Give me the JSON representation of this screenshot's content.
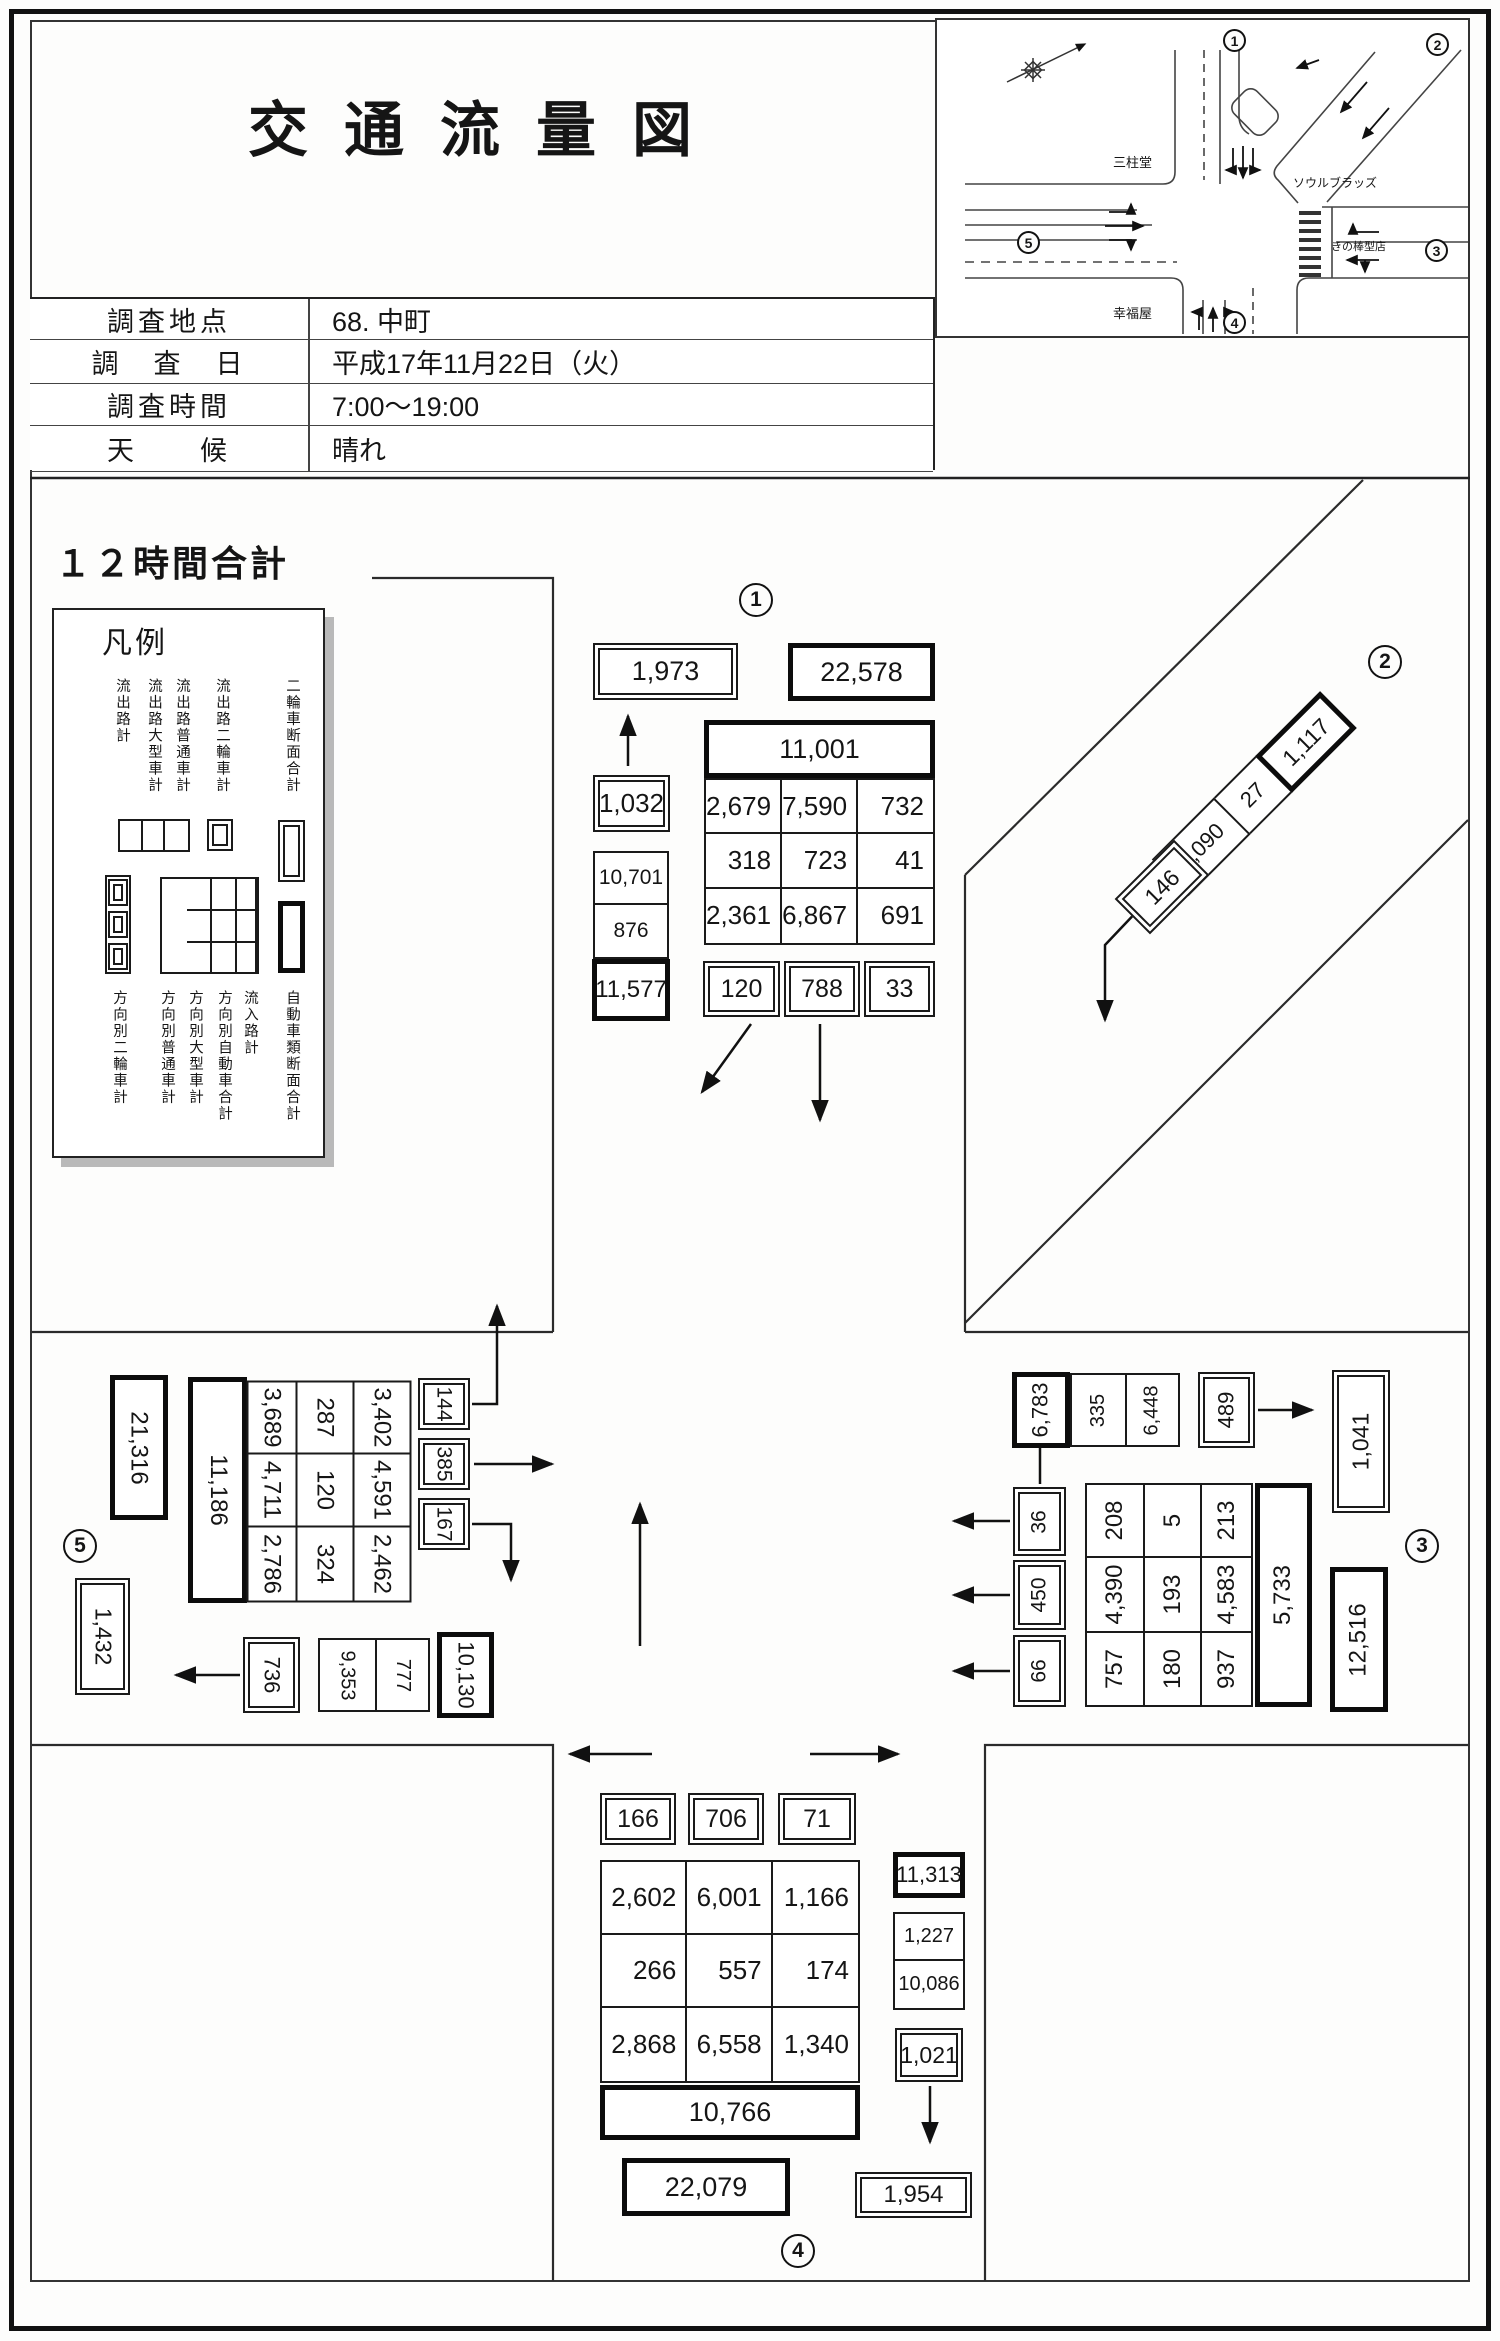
{
  "header": {
    "title": "交通流量図",
    "table": {
      "rows": [
        {
          "label": "調査地点",
          "value": "68. 中町"
        },
        {
          "label": "調　査　日",
          "value": "平成17年11月22日（火）"
        },
        {
          "label": "調査時間",
          "value": "7:00～19:00"
        },
        {
          "label": "天　　候",
          "value": "晴れ"
        }
      ]
    }
  },
  "inset_map": {
    "junctions": {
      "n1": "1",
      "n2": "2",
      "n3": "3",
      "n4": "4",
      "n5": "5"
    },
    "buildings": {
      "nw": "三柱堂",
      "ne": "ソウルブラッズ",
      "sw": "幸福屋",
      "se": "きの棒型店"
    }
  },
  "section_heading": "１２時間合計",
  "legend": {
    "title": "凡例",
    "top_labels": [
      "流出路計",
      "流出路大型車計",
      "流出路普通車計",
      "流出路二輪車計",
      "二輪車断面合計"
    ],
    "bottom_labels": [
      "方向別二輪車計",
      "方向別普通車計",
      "方向別大型車計",
      "方向別自動車合計",
      "流入路計",
      "自動車類断面合計"
    ]
  },
  "approach1": {
    "num": "1",
    "bike_section_total": "1,973",
    "auto_section_total": "22,578",
    "inflow_total": "11,001",
    "grid_rows": [
      [
        "2,679",
        "7,590",
        "732"
      ],
      [
        "318",
        "723",
        "41"
      ],
      [
        "2,361",
        "6,867",
        "691"
      ]
    ],
    "bike_outflow": "1,032",
    "outflow_pair": [
      "10,701",
      "876"
    ],
    "outflow_total": "11,577",
    "bike_directions": [
      "120",
      "788",
      "33"
    ]
  },
  "approach2": {
    "num": "2",
    "outflow_total": "1,117",
    "outflow_pair": [
      "1,090",
      "27"
    ],
    "bike_outflow": "146"
  },
  "approach3": {
    "num": "3",
    "outflow_total": "6,783",
    "outflow_pair": [
      "335",
      "6,448"
    ],
    "bike_outflow": "489",
    "bike_section_total": "1,041",
    "auto_section_total": "12,516",
    "inflow_total": "5,733",
    "grid_cols": [
      [
        "208",
        "4,390",
        "757"
      ],
      [
        "5",
        "193",
        "180"
      ],
      [
        "213",
        "4,583",
        "937"
      ]
    ],
    "bike_directions": [
      "36",
      "450",
      "66"
    ]
  },
  "approach4": {
    "num": "4",
    "bike_directions": [
      "166",
      "706",
      "71"
    ],
    "grid_rows": [
      [
        "2,602",
        "6,001",
        "1,166"
      ],
      [
        "266",
        "557",
        "174"
      ],
      [
        "2,868",
        "6,558",
        "1,340"
      ]
    ],
    "inflow_total": "10,766",
    "auto_section_total": "22,079",
    "outflow_total": "11,313",
    "outflow_pair": [
      "1,227",
      "10,086"
    ],
    "bike_outflow": "1,021",
    "bike_section_total": "1,954"
  },
  "approach5": {
    "num": "5",
    "auto_section_total": "21,316",
    "inflow_total": "11,186",
    "grid_cols": [
      [
        "3,689",
        "4,711",
        "2,786"
      ],
      [
        "287",
        "120",
        "324"
      ],
      [
        "3,402",
        "4,591",
        "2,462"
      ]
    ],
    "bike_directions": [
      "144",
      "385",
      "167"
    ],
    "bike_section_total": "1,432",
    "bike_outflow": "736",
    "outflow_pair": [
      "9,353",
      "777"
    ],
    "outflow_total": "10,130"
  }
}
